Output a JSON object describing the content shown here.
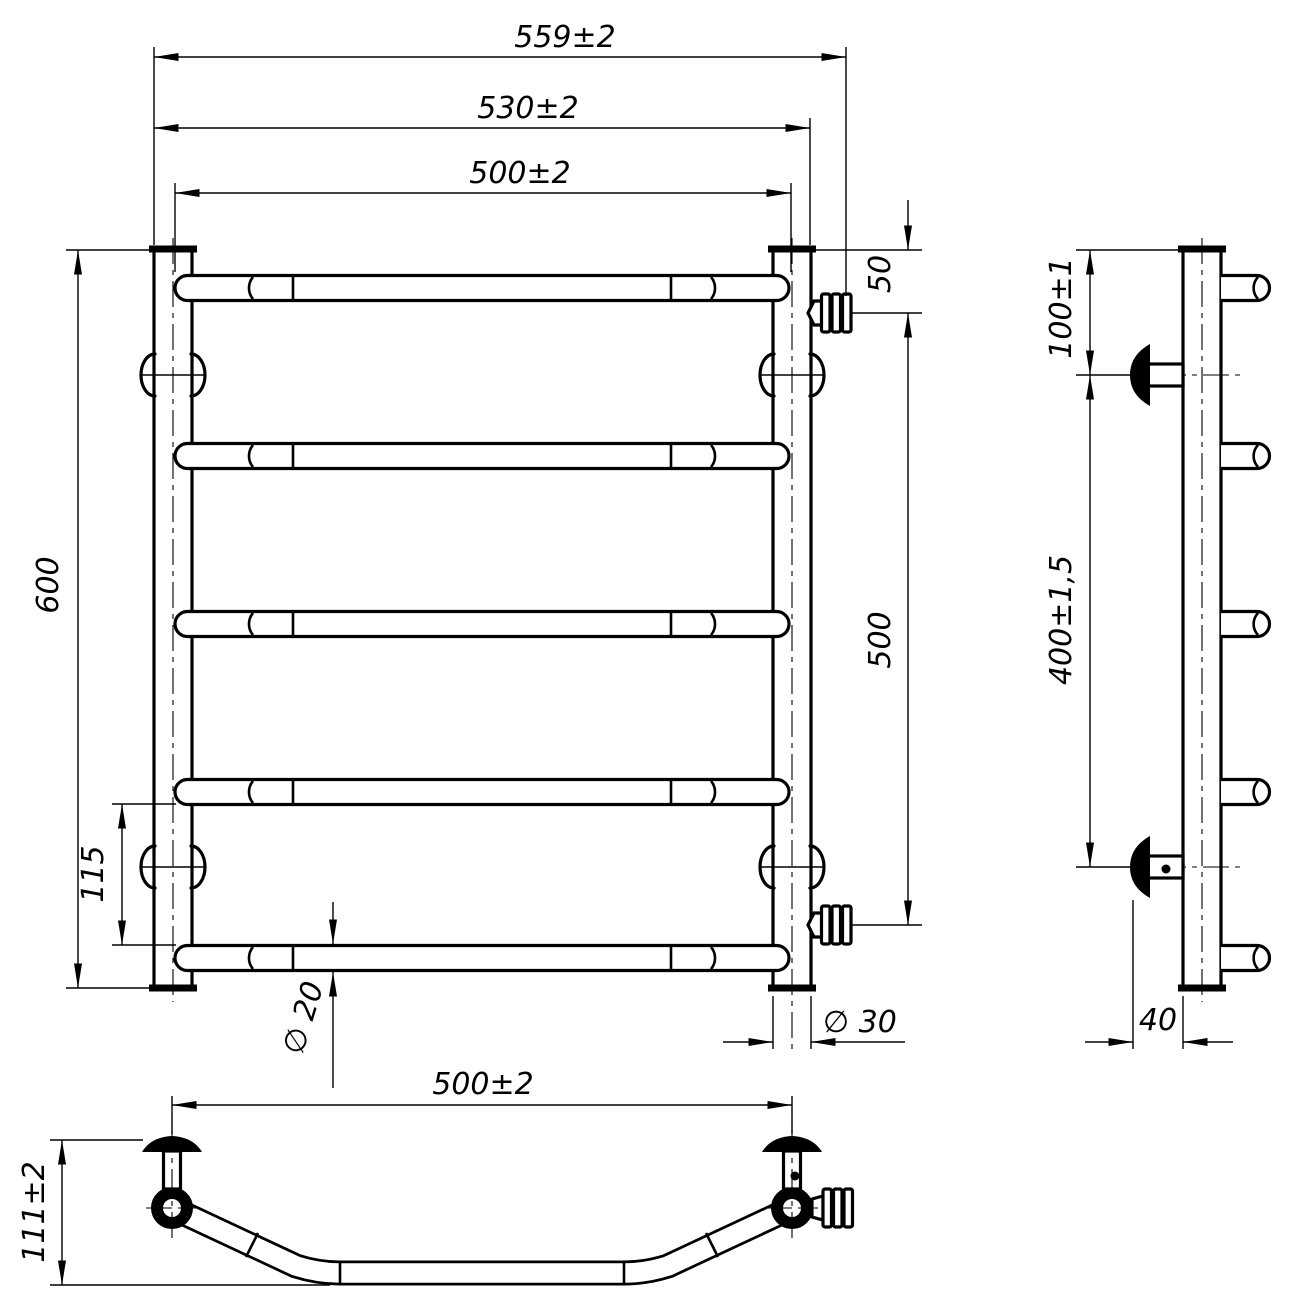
{
  "drawing": {
    "title": "Ladder towel rail – dimensioned technical drawing (front, side and top views)",
    "background": "#ffffff",
    "line_color": "#000000",
    "dims": {
      "front": {
        "overall_width": "559±2",
        "mount_width": "530±2",
        "rung_length": "500±2",
        "height": "600",
        "bottom_gap": "115",
        "valve_top_offset": "50",
        "valve_spacing": "500",
        "rung_diameter": "∅ 20",
        "post_diameter": "∅ 30"
      },
      "side": {
        "bracket_top_offset": "100±1",
        "bracket_spacing": "400±1,5",
        "bracket_depth": "40"
      },
      "top": {
        "bracket_span": "500±2",
        "depth": "111±2"
      }
    }
  }
}
